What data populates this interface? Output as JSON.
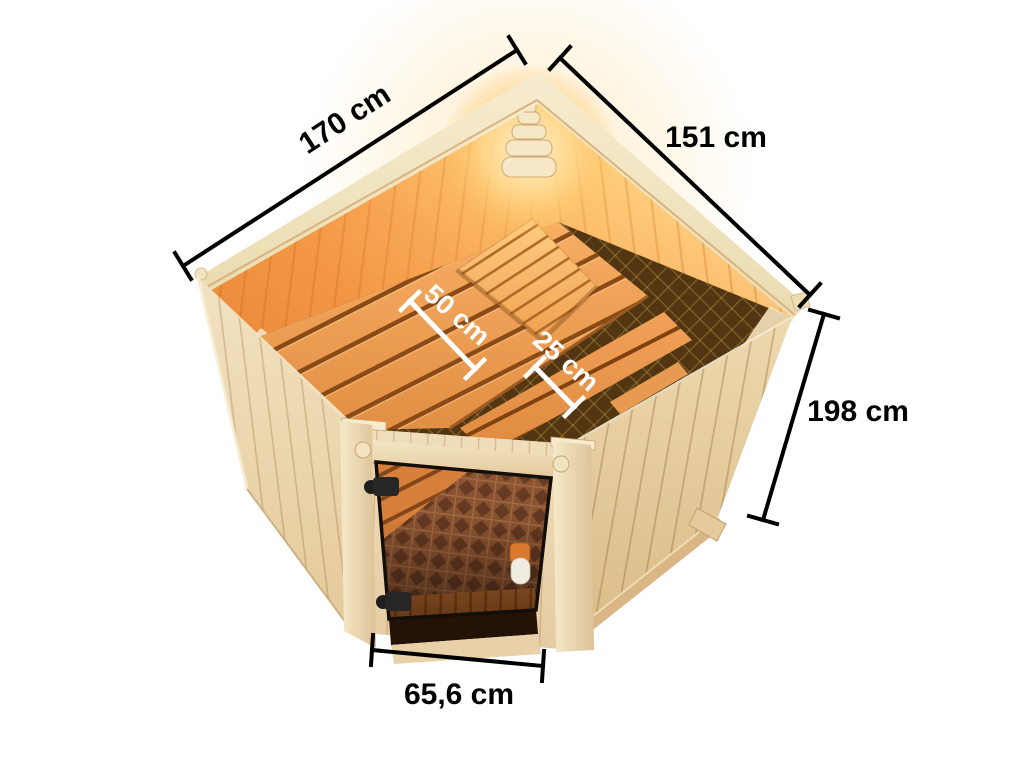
{
  "scene": {
    "background": "#ffffff",
    "description": "Isometric cutaway illustration of a corner sauna with tinted glass door, interior benches, backrest and corner lamp, annotated with dimensions"
  },
  "dimensions": {
    "left_width": {
      "label": "170 cm"
    },
    "right_width": {
      "label": "151 cm"
    },
    "height": {
      "label": "198 cm"
    },
    "upper_bench_depth": {
      "label": "50 cm"
    },
    "lower_bench_depth": {
      "label": "25 cm"
    },
    "door_width": {
      "label": "65,6 cm"
    }
  },
  "colors": {
    "dimension_line": "#000000",
    "dimension_text": "#000000",
    "interior_dimension_line": "#ffffff",
    "interior_dimension_text": "#ffffff",
    "exterior_wood": "#ecd9b4",
    "exterior_wood_shadow": "#dfc396",
    "rim_wood": "#f4e7c7",
    "interior_wall": "#f29a4a",
    "interior_glow": "#ffe2a0",
    "bench_wood": "#f2a55c",
    "bench_slat_gap": "#8a4a16",
    "floor_dark": "#4f330f",
    "door_glass": "#6b3d20",
    "hinge": "#262626",
    "handle_white": "#f1ece1",
    "handle_cap": "#d9782f"
  }
}
